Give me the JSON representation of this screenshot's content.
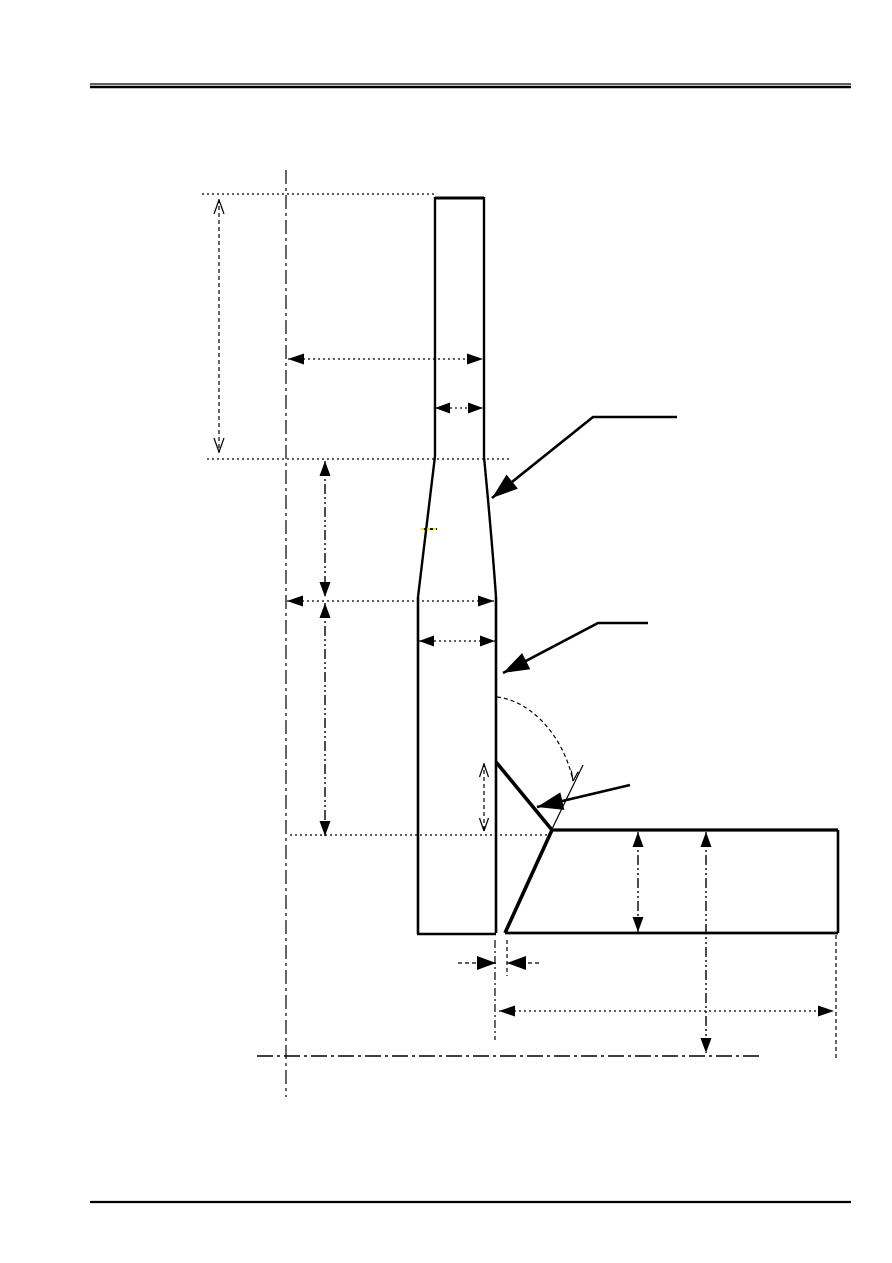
{
  "page": {
    "width": 892,
    "height": 1263,
    "background_color": "#ffffff",
    "line_color": "#000000",
    "highlight_color": "#ffff00"
  },
  "header_rule": {
    "x1": 90,
    "x2": 851,
    "thin_y": 84,
    "thin_width": 1.3,
    "thick_y": 87,
    "thick_width": 2.6
  },
  "footer_rule": {
    "x1": 90,
    "x2": 851,
    "y": 1202,
    "width": 2.2
  },
  "diagram": {
    "outline_segments": [
      {
        "name": "stem-top-edge",
        "x1": 435,
        "y1": 198,
        "x2": 484,
        "y2": 198,
        "w": 3.0
      },
      {
        "name": "stem-left-edge-upper",
        "x1": 435,
        "y1": 197,
        "x2": 435,
        "y2": 456,
        "w": 2.4
      },
      {
        "name": "stem-right-edge-upper",
        "x1": 484,
        "y1": 197,
        "x2": 484,
        "y2": 457,
        "w": 2.4
      },
      {
        "name": "stem-left-edge-lower",
        "x1": 418,
        "y1": 597,
        "x2": 418,
        "y2": 934,
        "w": 2.6
      },
      {
        "name": "stem-right-edge-lower",
        "x1": 496,
        "y1": 597,
        "x2": 496,
        "y2": 933,
        "w": 2.6
      },
      {
        "name": "stem-bottom-edge",
        "x1": 417,
        "y1": 934,
        "x2": 496,
        "y2": 934,
        "w": 2.6
      },
      {
        "name": "stem-bevel-face",
        "x1": 496,
        "y1": 762,
        "x2": 552,
        "y2": 830,
        "w": 3.6
      },
      {
        "name": "plate-top-edge",
        "x1": 552,
        "y1": 830,
        "x2": 838,
        "y2": 830,
        "w": 3.2
      },
      {
        "name": "plate-right-edge",
        "x1": 838,
        "y1": 830,
        "x2": 838,
        "y2": 933,
        "w": 2.6
      },
      {
        "name": "plate-bottom-edge",
        "x1": 505,
        "y1": 933,
        "x2": 838,
        "y2": 933,
        "w": 2.8
      },
      {
        "name": "plate-end-bevel",
        "x1": 552,
        "y1": 830,
        "x2": 505,
        "y2": 933,
        "w": 3.6
      },
      {
        "name": "bevel-extension-line",
        "x1": 552,
        "y1": 829,
        "x2": 583,
        "y2": 765,
        "w": 1.2
      }
    ],
    "outline_curves": [
      {
        "name": "stem-left-taper",
        "d": "M 435 456 Q 425 540 418 597",
        "w": 2.4
      },
      {
        "name": "stem-right-taper",
        "d": "M 484 457 Q 492 540 496 597",
        "w": 2.4
      }
    ],
    "angle_arc": {
      "name": "groove-angle-arc",
      "d": "M 497 697 C 532 701 564 737 573 781",
      "w": 1.2,
      "dash": "4,3",
      "end_arrow": {
        "x": 573,
        "y": 781,
        "angle": 100,
        "style": "open",
        "len": 10,
        "halfw": 3.5
      }
    },
    "reference_lines": [
      {
        "name": "ref-top-of-stem",
        "x1": 202,
        "y1": 194,
        "x2": 434,
        "y2": 194,
        "dash": "2,3",
        "w": 1.2
      },
      {
        "name": "ref-taper-start",
        "x1": 207,
        "y1": 459,
        "x2": 510,
        "y2": 459,
        "dash": "2,3",
        "w": 1.2
      },
      {
        "name": "ref-plate-top-extension",
        "x1": 290,
        "y1": 835,
        "x2": 548,
        "y2": 835,
        "dash": "2,3",
        "w": 1.2
      },
      {
        "name": "ref-bottom-datum",
        "x1": 257,
        "y1": 1056,
        "x2": 760,
        "y2": 1056,
        "dash": "16,4,3,4",
        "w": 1.4
      },
      {
        "name": "ref-vertical-centerline",
        "x1": 286,
        "y1": 170,
        "x2": 286,
        "y2": 1097,
        "dash": "14,4,3,4",
        "w": 1.2
      },
      {
        "name": "ext-root-left",
        "x1": 495,
        "y1": 940,
        "x2": 495,
        "y2": 1040,
        "dash": "8,3,2,3",
        "w": 1.2
      },
      {
        "name": "ext-root-right",
        "x1": 507,
        "y1": 940,
        "x2": 507,
        "y2": 976,
        "dash": "4,3",
        "w": 1.2
      },
      {
        "name": "ext-plate-right-end",
        "x1": 836,
        "y1": 935,
        "x2": 836,
        "y2": 1058,
        "dash": "4,3",
        "w": 1.2
      }
    ],
    "dimensions": [
      {
        "name": "dim-tip-section-length",
        "lines": [
          [
            219,
            199,
            219,
            453
          ]
        ],
        "dash": "4,3",
        "w": 1.2,
        "arrows": [
          {
            "x": 219,
            "y": 200,
            "angle": -90,
            "style": "open",
            "len": 14,
            "halfw": 5
          },
          {
            "x": 219,
            "y": 452,
            "angle": 90,
            "style": "open",
            "len": 14,
            "halfw": 5
          }
        ]
      },
      {
        "name": "dim-taper-section-length",
        "lines": [
          [
            325,
            461,
            325,
            597
          ]
        ],
        "dash": "10,3,2,3,2,3",
        "w": 1.4,
        "arrows": [
          {
            "x": 325,
            "y": 461,
            "angle": -90,
            "style": "filled",
            "len": 15,
            "halfw": 5.5
          },
          {
            "x": 325,
            "y": 597,
            "angle": 90,
            "style": "filled",
            "len": 15,
            "halfw": 5.5
          }
        ]
      },
      {
        "name": "dim-lower-section-length",
        "lines": [
          [
            325,
            603,
            325,
            836
          ]
        ],
        "dash": "10,3,2,3,2,3",
        "w": 1.4,
        "arrows": [
          {
            "x": 325,
            "y": 603,
            "angle": -90,
            "style": "filled",
            "len": 15,
            "halfw": 5.5
          },
          {
            "x": 325,
            "y": 836,
            "angle": 90,
            "style": "filled",
            "len": 15,
            "halfw": 5.5
          }
        ]
      },
      {
        "name": "dim-centerline-to-tip-edge",
        "lines": [
          [
            288,
            359,
            483,
            359
          ]
        ],
        "dash": "2,3",
        "w": 1.2,
        "arrows": [
          {
            "x": 288,
            "y": 359,
            "angle": 180,
            "style": "filled",
            "len": 16,
            "halfw": 5.5
          },
          {
            "x": 483,
            "y": 359,
            "angle": 0,
            "style": "filled",
            "len": 16,
            "halfw": 5.5
          }
        ]
      },
      {
        "name": "dim-tip-width",
        "lines": [
          [
            435,
            408,
            483,
            408
          ]
        ],
        "dash": "2,3",
        "w": 1.2,
        "arrows": [
          {
            "x": 435,
            "y": 408,
            "angle": 180,
            "style": "filled",
            "len": 15,
            "halfw": 5.5
          },
          {
            "x": 483,
            "y": 408,
            "angle": 0,
            "style": "filled",
            "len": 15,
            "halfw": 5.5
          }
        ]
      },
      {
        "name": "dim-centerline-to-lower-edge",
        "lines": [
          [
            287,
            601,
            494,
            601
          ]
        ],
        "dash": "2,3",
        "w": 1.2,
        "arrows": [
          {
            "x": 287,
            "y": 601,
            "angle": 180,
            "style": "filled",
            "len": 16,
            "halfw": 5.5
          },
          {
            "x": 494,
            "y": 601,
            "angle": 0,
            "style": "filled",
            "len": 16,
            "halfw": 5.5
          }
        ]
      },
      {
        "name": "dim-lower-section-width",
        "lines": [
          [
            419,
            641,
            495,
            641
          ]
        ],
        "dash": "2,3",
        "w": 1.2,
        "arrows": [
          {
            "x": 419,
            "y": 641,
            "angle": 180,
            "style": "filled",
            "len": 15,
            "halfw": 5.5
          },
          {
            "x": 495,
            "y": 641,
            "angle": 0,
            "style": "filled",
            "len": 15,
            "halfw": 5.5
          }
        ]
      },
      {
        "name": "dim-root-face-height",
        "lines": [
          [
            484,
            763,
            484,
            832
          ]
        ],
        "dash": "4,3",
        "w": 1.2,
        "arrows": [
          {
            "x": 484,
            "y": 764,
            "angle": -90,
            "style": "open",
            "len": 13,
            "halfw": 4.5
          },
          {
            "x": 484,
            "y": 831,
            "angle": 90,
            "style": "open",
            "len": 13,
            "halfw": 4.5
          }
        ]
      },
      {
        "name": "dim-plate-thickness",
        "lines": [
          [
            638,
            832,
            638,
            932
          ]
        ],
        "dash": "10,3,2,3,2,3",
        "w": 1.4,
        "arrows": [
          {
            "x": 638,
            "y": 832,
            "angle": -90,
            "style": "filled",
            "len": 15,
            "halfw": 5.5
          },
          {
            "x": 638,
            "y": 932,
            "angle": 90,
            "style": "filled",
            "len": 15,
            "halfw": 5.5
          }
        ]
      },
      {
        "name": "dim-plate-top-to-datum",
        "lines": [
          [
            706,
            832,
            706,
            1053
          ]
        ],
        "dash": "10,3,2,3,2,3",
        "w": 1.4,
        "arrows": [
          {
            "x": 706,
            "y": 832,
            "angle": -90,
            "style": "filled",
            "len": 15,
            "halfw": 5.5
          },
          {
            "x": 706,
            "y": 1053,
            "angle": 90,
            "style": "filled",
            "len": 15,
            "halfw": 5.5
          }
        ]
      },
      {
        "name": "dim-root-gap",
        "lines": [
          [
            458,
            963,
            496,
            963
          ],
          [
            507,
            963,
            542,
            963
          ]
        ],
        "dash": "4,3",
        "w": 1.2,
        "arrows": [
          {
            "x": 496,
            "y": 963,
            "angle": 0,
            "style": "filled",
            "len": 19,
            "halfw": 7
          },
          {
            "x": 507,
            "y": 963,
            "angle": 180,
            "style": "filled",
            "len": 19,
            "halfw": 7
          }
        ]
      },
      {
        "name": "dim-plate-length",
        "lines": [
          [
            499,
            1011,
            834,
            1011
          ]
        ],
        "dash": "2,3",
        "w": 1.3,
        "arrows": [
          {
            "x": 499,
            "y": 1011,
            "angle": 180,
            "style": "filled",
            "len": 16,
            "halfw": 5.5
          },
          {
            "x": 834,
            "y": 1011,
            "angle": 0,
            "style": "filled",
            "len": 16,
            "halfw": 5.5
          }
        ]
      }
    ],
    "callouts": [
      {
        "name": "callout-taper-region",
        "points": [
          [
            677,
            417
          ],
          [
            593,
            417
          ],
          [
            492,
            498
          ]
        ],
        "w": 2.6,
        "tip": {
          "x": 492,
          "y": 498,
          "angle": 141,
          "style": "filled",
          "len": 26,
          "halfw": 9
        }
      },
      {
        "name": "callout-lower-section",
        "points": [
          [
            648,
            623
          ],
          [
            598,
            623
          ],
          [
            503,
            673
          ]
        ],
        "w": 2.6,
        "tip": {
          "x": 503,
          "y": 673,
          "angle": 153,
          "style": "filled",
          "len": 26,
          "halfw": 9
        }
      },
      {
        "name": "callout-bevel-face",
        "points": [
          [
            630,
            785
          ],
          [
            537,
            807
          ]
        ],
        "w": 2.6,
        "tip": {
          "x": 537,
          "y": 807,
          "angle": 167,
          "style": "filled",
          "len": 26,
          "halfw": 9
        }
      }
    ],
    "highlight_mark": {
      "name": "yellow-dash-mark",
      "x1": 421,
      "y1": 529,
      "x2": 437,
      "y2": 529,
      "base_w": 1.8,
      "dash": "3,3"
    }
  }
}
